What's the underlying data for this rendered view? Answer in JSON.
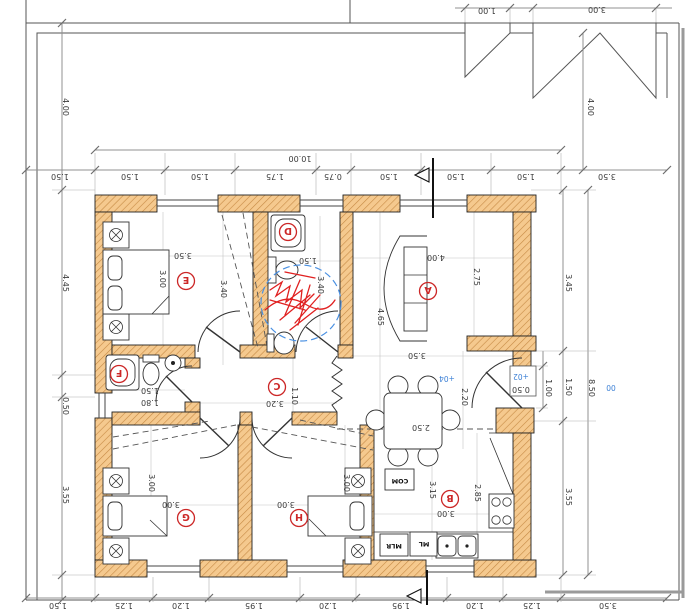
{
  "rooms": {
    "A": {
      "label": "A",
      "dim_w": "4.00",
      "dim_h": "2.75",
      "dim_len": "4.65",
      "dim_w2": "3.50"
    },
    "B": {
      "label": "B",
      "dim_w": "3.00",
      "dim_h": "3.15",
      "dim_h2": "2.85",
      "dim_table": "2.50",
      "dim_entry": "2.20"
    },
    "C": {
      "label": "C",
      "dim_w": "3.20",
      "dim_h": "1.10"
    },
    "D": {
      "label": "D",
      "dim_w": "1.50",
      "dim_h": "3.40"
    },
    "E": {
      "label": "E",
      "dim_w": "3.50",
      "dim_w2": "3.00",
      "dim_h": "3.40"
    },
    "F": {
      "label": "F",
      "dim_a": "1.50",
      "dim_b": "1.80"
    },
    "G": {
      "label": "G",
      "dim_w": "3.00",
      "dim_h": "3.00"
    },
    "H": {
      "label": "H",
      "dim_w": "3.00",
      "dim_h": "3.00"
    }
  },
  "chains": {
    "top": {
      "outside_left": "1.50",
      "segments": [
        "1.50",
        "1.50",
        "1.75",
        "0.75",
        "1.50",
        "1.50",
        "1.50"
      ],
      "overall": "10.00",
      "outside_right": "3.50"
    },
    "bottom": {
      "outside_left": "1.50",
      "segments": [
        "1.25",
        "1.20",
        "1.95",
        "1.20",
        "1.95",
        "1.20",
        "1.25"
      ],
      "outside_right": "3.50"
    },
    "left": {
      "segments": [
        "4.00",
        "4.45",
        "0.50",
        "3.55"
      ]
    },
    "right": {
      "yard": "4.00",
      "segments": [
        "3.45",
        "1.50",
        "3.55"
      ],
      "overall": "8.50",
      "door_width": "1.00",
      "threshold": "0.50"
    }
  },
  "gates": {
    "pedestrian_width": "1.00",
    "vehicle_width": "3.00"
  },
  "levels": {
    "outside": "00",
    "step": "+02",
    "entry": "+04"
  },
  "kitchen": {
    "com": "COM",
    "ml": "ML",
    "mlr": "MLR"
  },
  "colors": {
    "wall_fill": "#f5c98e",
    "wall_hatch": "#c68a45",
    "dim_line": "#909090",
    "room_label": "#cc2727",
    "level_blue": "#3a7fd5",
    "markup_red": "#e02020",
    "markup_blue": "#4a90e2"
  }
}
